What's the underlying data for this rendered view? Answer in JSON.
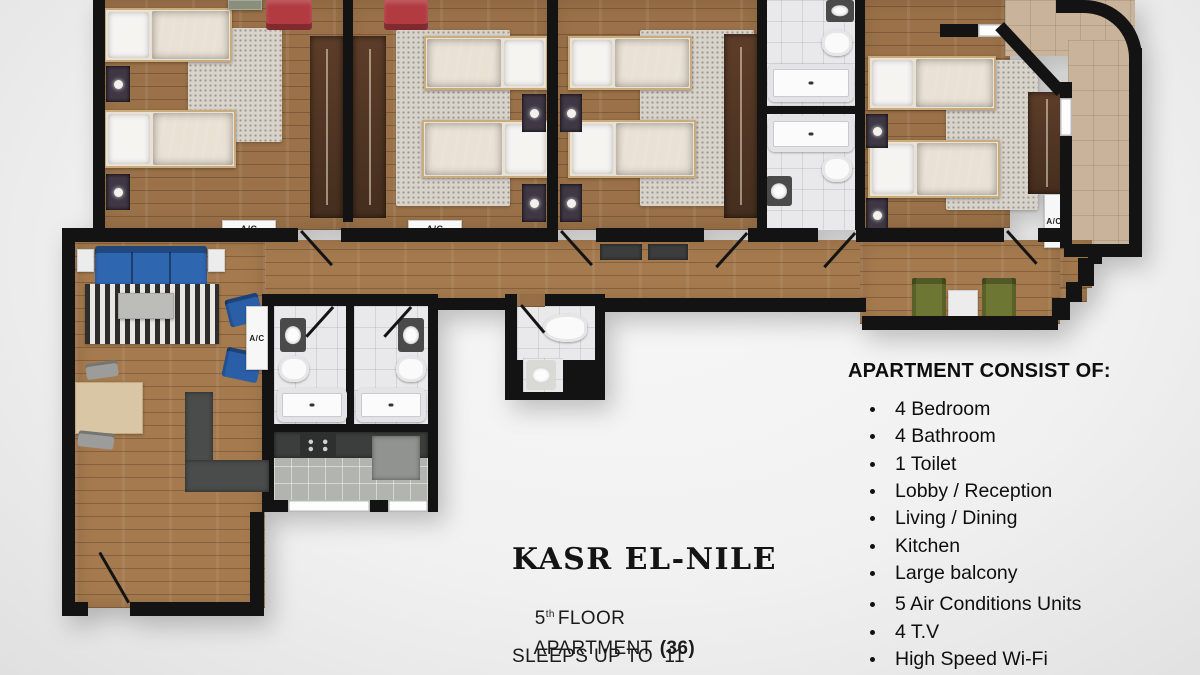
{
  "info": {
    "title": "KASR EL-NILE",
    "floor_number": "5",
    "floor_ordinal": "th",
    "floor_word": "FLOOR",
    "apartment_word": "APARTMENT",
    "apartment_number": "(36)",
    "sleeps_text": "SLEEPS UP TO  11"
  },
  "consist": {
    "heading": "APARTMENT CONSIST OF:",
    "items": [
      "4 Bedroom",
      "4 Bathroom",
      "1 Toilet",
      "Lobby / Reception",
      "Living / Dining",
      "Kitchen",
      "Large balcony",
      "5 Air Conditions Units",
      "4 T.V",
      "High Speed Wi-Fi"
    ]
  },
  "plan": {
    "ac_label": "A/C",
    "colors": {
      "wall": "#131313",
      "wood_floor": "#9a7148",
      "bath_tile": "#e9e9eb",
      "kitchen_tile": "#b2b4b0",
      "balcony_tile": "#c9b49b",
      "rug": "#d8d4cc",
      "bed_duvet": "#5a5d62",
      "sofa_blue": "#2f66b0",
      "chair_red": "#b23b42",
      "chair_green": "#6d7733",
      "wardrobe_brown": "#52351f"
    }
  }
}
